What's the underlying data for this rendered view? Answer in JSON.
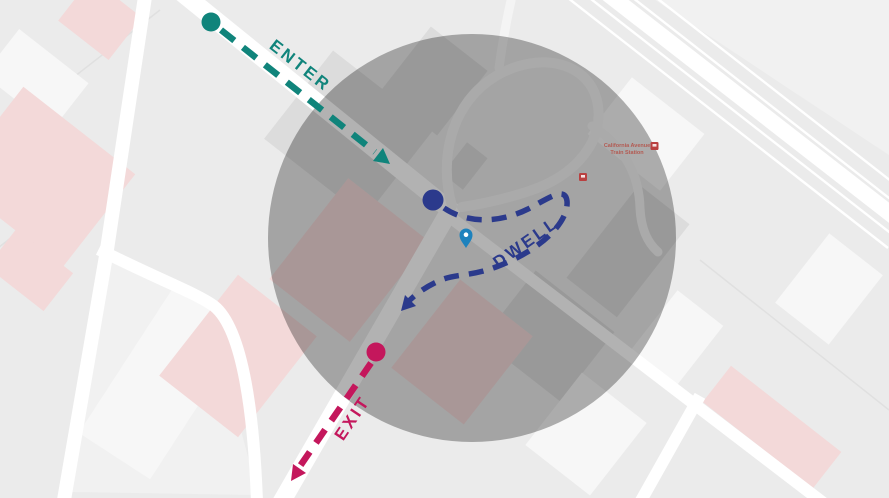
{
  "colors": {
    "background": "#ebebeb",
    "road": "#ffffff",
    "minor_road": "#f4f4f4",
    "block_light": "#f1f1f1",
    "building_gray": "#dcdcdc",
    "building_light": "#f7f7f7",
    "building_pink": "#f3d9d9",
    "parcel_line": "#e0e0e0",
    "overlay": "#000000",
    "enter": "#10847b",
    "dwell": "#2b3a8c",
    "exit": "#c4175c",
    "pin": "#1d82bd",
    "station_text": "#b35a52",
    "station_icon": "#b94040"
  },
  "overlay": {
    "opacity": "0.3"
  },
  "annotations": {
    "enter": {
      "label": "ENTER"
    },
    "dwell": {
      "label": "DWELL"
    },
    "exit": {
      "label": "EXIT"
    }
  },
  "map": {
    "station": {
      "line1": "California Avenue",
      "line2": "Train Station"
    }
  },
  "icons": {
    "pin": "location-pin",
    "station": "transit-station",
    "enter_arrow": "arrow-down-right",
    "exit_arrow": "arrow-down-left",
    "dwell_arrow": "curved-arrow"
  }
}
